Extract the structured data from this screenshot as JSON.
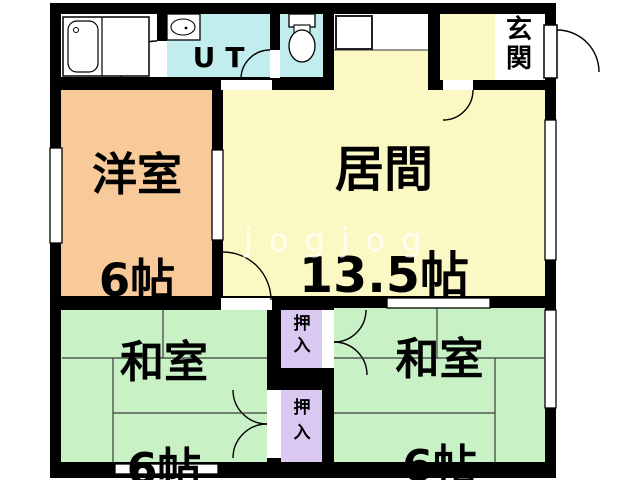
{
  "colors": {
    "wall": "#000000",
    "background": "#FFFFFF",
    "western_room_fill": "#F8CA9A",
    "living_room_fill": "#FBF8C4",
    "japanese_room_fill": "#C8F2C6",
    "closet_fill": "#D9C8F0",
    "wet_area_fill": "#C2EDEE",
    "white_area": "#FFFFFF"
  },
  "rooms": {
    "western": {
      "name": "洋室",
      "size": "6帖"
    },
    "living": {
      "name": "居間",
      "size": "13.5帖"
    },
    "japanese_left": {
      "name": "和室",
      "size": "6帖"
    },
    "japanese_right": {
      "name": "和室",
      "size": "6帖"
    },
    "entrance": {
      "name": "玄関"
    },
    "utility": {
      "name": "UT"
    },
    "closet_top": {
      "name": "押入"
    },
    "closet_bottom": {
      "name": "押入"
    }
  },
  "watermark": "jogjog"
}
